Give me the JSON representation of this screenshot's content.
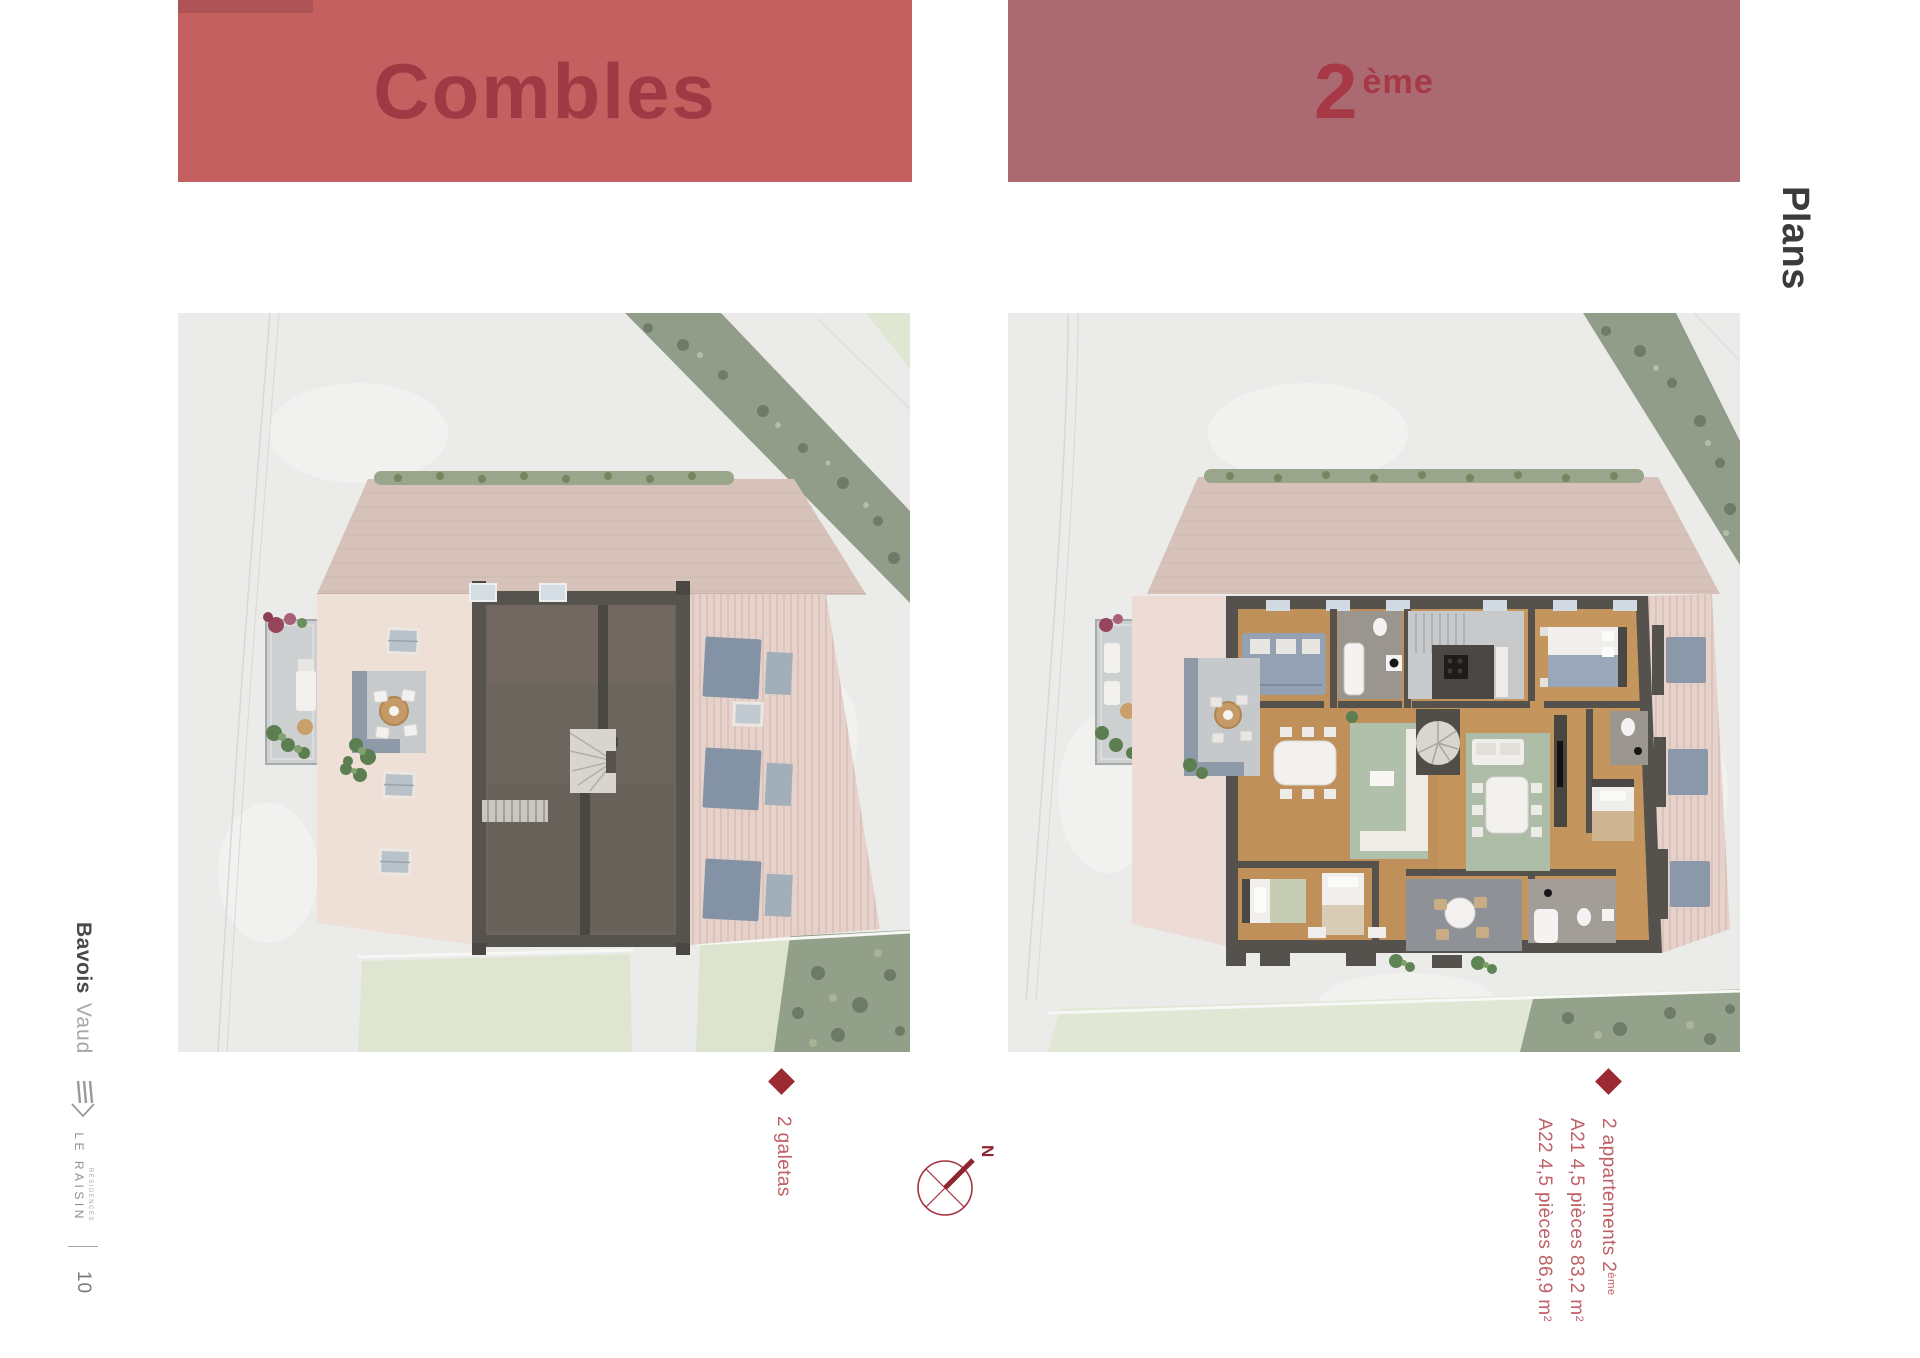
{
  "theme": {
    "banner-left-bg": "#c4605f",
    "banner-left-text": "#9e3a44",
    "banner-left-stripe": "#ae5356",
    "banner-right-bg": "#ab6a72",
    "banner-right-text": "#a63945",
    "accent-red": "#9c2a33",
    "caption-text": "#bf5f66",
    "compass-red": "#99303b",
    "plans-text": "#3b3b3b",
    "sidebar-dark": "#4a4a4a",
    "sidebar-light": "#a6a6a6",
    "brand-gray": "#909090",
    "page-number-color": "#7a7a7a"
  },
  "headers": {
    "left_title": "Combles",
    "right_title_base": "2",
    "right_title_sup": "ème"
  },
  "side_label": "Plans",
  "sidebar": {
    "location": "Bavois",
    "region": "Vaud",
    "brand_small": "RÉSIDENCES",
    "brand_name": "LE RAISIN",
    "page_number": "10"
  },
  "captions": {
    "left": {
      "title": "2 galetas"
    },
    "right": {
      "line1_base": "2 appartements 2",
      "line1_sup": "ème",
      "line2_base": "A21 4,5 pièces 83,2 m",
      "line2_sup": "2",
      "line3_base": "A22 4,5 pièces 86,9 m",
      "line3_sup": "2"
    }
  },
  "compass": {
    "north_label": "N"
  }
}
